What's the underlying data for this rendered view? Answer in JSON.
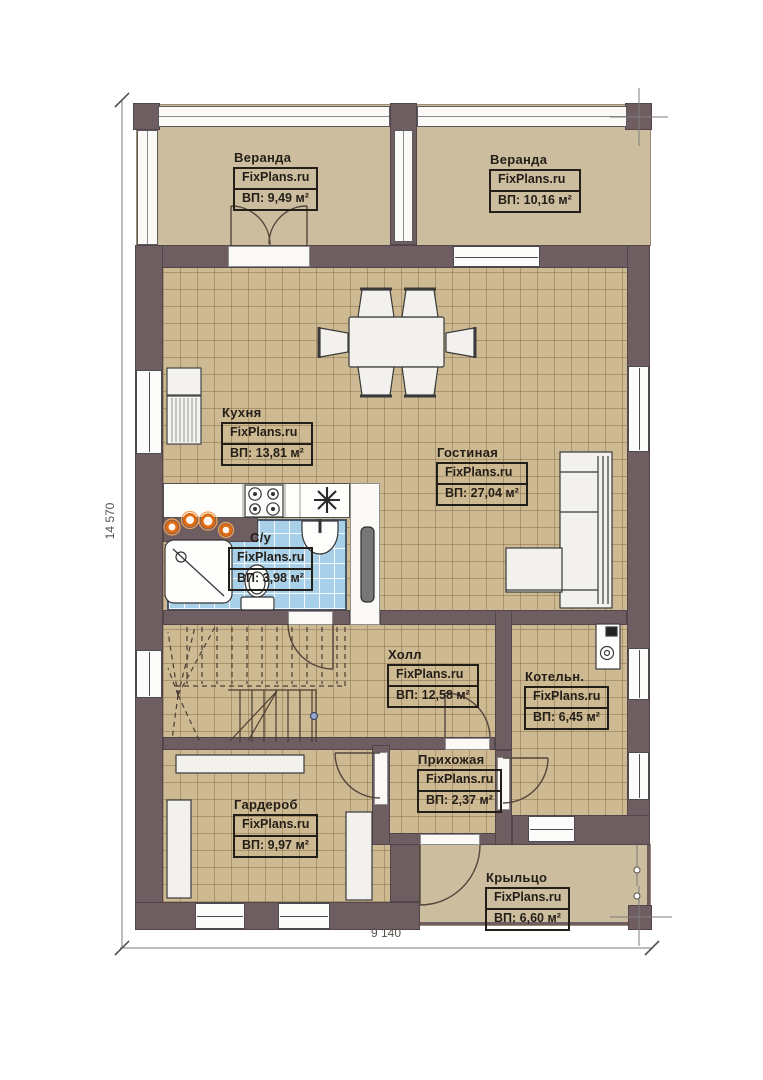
{
  "plan": {
    "watermark": "FixPlans.ru",
    "dimensions": {
      "height_mm": "14 570",
      "width_mm": "9 140"
    },
    "rooms": [
      {
        "id": "veranda-left",
        "name": "Веранда",
        "area": "ВП: 9,49 м²"
      },
      {
        "id": "veranda-right",
        "name": "Веранда",
        "area": "ВП: 10,16 м²"
      },
      {
        "id": "kitchen",
        "name": "Кухня",
        "area": "ВП: 13,81 м²"
      },
      {
        "id": "living-room",
        "name": "Гостиная",
        "area": "ВП: 27,04 м²"
      },
      {
        "id": "bathroom",
        "name": "С/у",
        "area": "ВП: 3,98 м²"
      },
      {
        "id": "hall",
        "name": "Холл",
        "area": "ВП: 12,58 м²"
      },
      {
        "id": "boiler-room",
        "name": "Котельн.",
        "area": "ВП: 6,45 м²"
      },
      {
        "id": "entry",
        "name": "Прихожая",
        "area": "ВП: 2,37 м²"
      },
      {
        "id": "wardrobe",
        "name": "Гардероб",
        "area": "ВП: 9,97 м²"
      },
      {
        "id": "porch",
        "name": "Крыльцо",
        "area": "ВП: 6,60 м²"
      }
    ],
    "palette": {
      "wall": "#6f5e61",
      "floor_tile": "#cdb992",
      "veranda_floor": "#cbbd9d",
      "bathroom_tile": "#a8d0e8",
      "fixture_white": "#f2f1ee",
      "accent_orange": "#e06a10"
    }
  }
}
